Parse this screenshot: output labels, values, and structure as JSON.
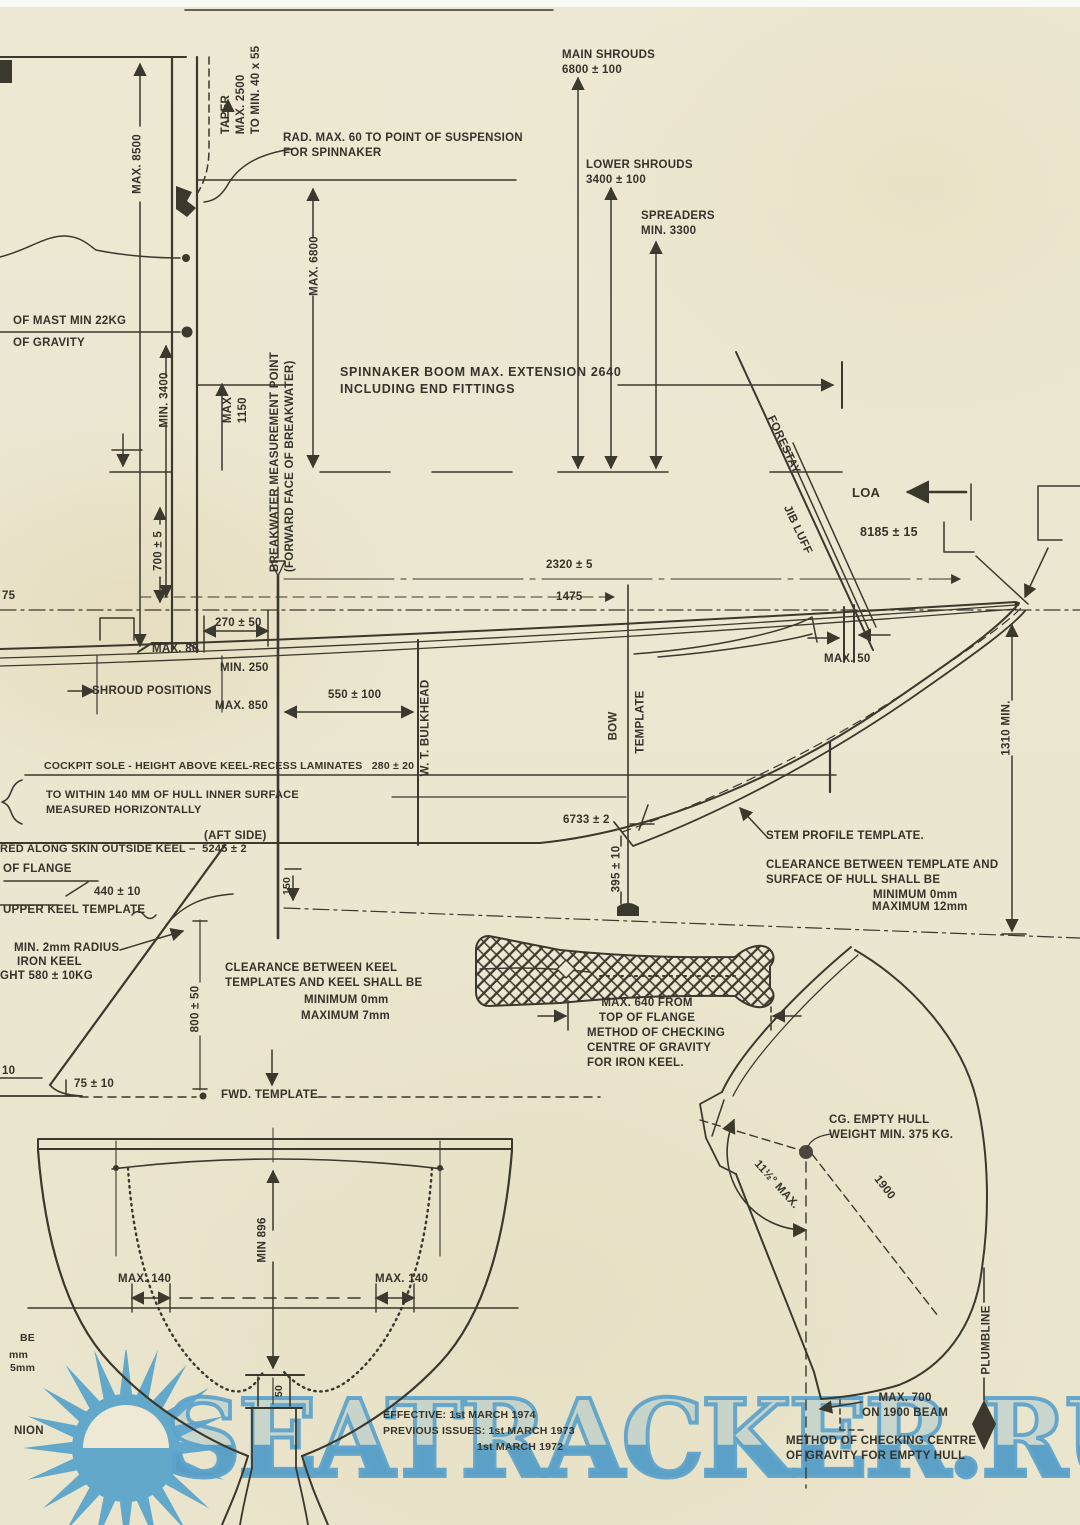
{
  "page": {
    "paper_color": "#ece8d3",
    "ink_color": "#3b382d",
    "watermark_color": "#5ba4ca"
  },
  "watermark": {
    "text": "SEATRACKER.RU"
  },
  "rig": {
    "max_height": "MAX. 8500",
    "taper": "TAPER\nMAX. 2500\nTO MIN. 40 x 55",
    "spinnaker_radius": "RAD. MAX. 60 TO POINT OF SUSPENSION\nFOR SPINNAKER",
    "main_shrouds": "MAIN SHROUDS\n6800 ± 100",
    "lower_shrouds": "LOWER SHROUDS\n3400 ± 100",
    "spreaders": "SPREADERS\nMIN. 3300",
    "mast_weight": "OF MAST MIN 22KG",
    "mast_gravity": "OF GRAVITY",
    "min_3400": "MIN. 3400",
    "max_1150": "MAX\n1150",
    "max_6800": "MAX. 6800",
    "breakwater_point": "BREAKWATER MEASUREMENT POINT\n(FORWARD FACE OF BREAKWATER)",
    "spinnaker_boom": "SPINNAKER BOOM MAX. EXTENSION 2640\nINCLUDING END FITTINGS",
    "dim_700": "700 ± 5",
    "forestay": "FORESTAY",
    "jib_luff": "JIB LUFF",
    "loa": "LOA",
    "loa_value": "8185 ± 15"
  },
  "hull": {
    "dim_775": "75",
    "dim_2320": "2320 ± 5",
    "dim_1475": "1475",
    "dim_270": "270 ± 50",
    "max_80": "MAX. 80",
    "min_250": "MIN. 250",
    "shroud_positions": "SHROUD POSITIONS",
    "max_850": "MAX. 850",
    "dim_550": "550 ± 100",
    "max_50": "MAX. 50",
    "wt_bulkhead": "W. T. BULKHEAD",
    "bow": "BOW",
    "template": "TEMPLATE",
    "min_1310": "1310 MIN.",
    "cockpit_sole": "COCKPIT SOLE - HEIGHT ABOVE KEEL-RECESS LAMINATES   280 ± 20",
    "inner_surface": "TO WITHIN 140 MM OF HULL INNER SURFACE\nMEASURED HORIZONTALLY",
    "aft_side": "(AFT SIDE)",
    "along_skin": "RED ALONG SKIN OUTSIDE KEEL –  5245 ± 2",
    "dim_150": "150",
    "dim_6733": "6733 ± 2",
    "dim_395": "395 ± 10",
    "stem_template": "STEM PROFILE TEMPLATE.",
    "stem_clearance": "CLEARANCE BETWEEN TEMPLATE AND\nSURFACE OF HULL SHALL BE",
    "stem_clearance_min": "MINIMUM 0mm",
    "stem_clearance_max": "MAXIMUM 12mm"
  },
  "keel": {
    "of_flange": "OF FLANGE",
    "dim_440": "440 ± 10",
    "upper_template": "UPPER KEEL TEMPLATE",
    "radius_note": "MIN. 2mm RADIUS",
    "iron_keel": "IRON KEEL",
    "keel_weight": "GHT 580 ± 10KG",
    "dim_800": "800 ± 50",
    "clearance": "CLEARANCE BETWEEN KEEL\nTEMPLATES AND KEEL SHALL BE",
    "clearance_min": "MINIMUM 0mm",
    "clearance_max": "MAXIMUM 7mm",
    "dim_75": "75 ± 10",
    "dim_10": "10",
    "fwd_template": "FWD. TEMPLATE",
    "max_640": "MAX. 640 FROM\nTOP OF FLANGE",
    "method_iron": "METHOD OF CHECKING\nCENTRE OF GRAVITY\nFOR IRON KEEL."
  },
  "cg_check": {
    "cg_empty": "CG. EMPTY HULL\nWEIGHT MIN. 375 KG.",
    "angle_max": "11½° MAX.",
    "dim_1900": "1900",
    "plumbline": "PLUMBLINE",
    "max_700": "MAX. 700\nON 1900 BEAM",
    "method_empty": "METHOD OF CHECKING CENTRE\nOF GRAVITY FOR EMPTY HULL"
  },
  "section": {
    "min_896": "MIN 896",
    "max_140_left": "MAX. 140",
    "max_140_right": "MAX. 140",
    "dim_50": "50",
    "frag_be": "BE",
    "frag_mm": "mm",
    "frag_5mm": "5mm",
    "frag_nion": "NION"
  },
  "footer": {
    "effective": "EFFECTIVE: 1st MARCH 1974",
    "previous_issues": "PREVIOUS ISSUES: 1st MARCH 1973",
    "previous_issues_2": "1st MARCH 1972"
  }
}
